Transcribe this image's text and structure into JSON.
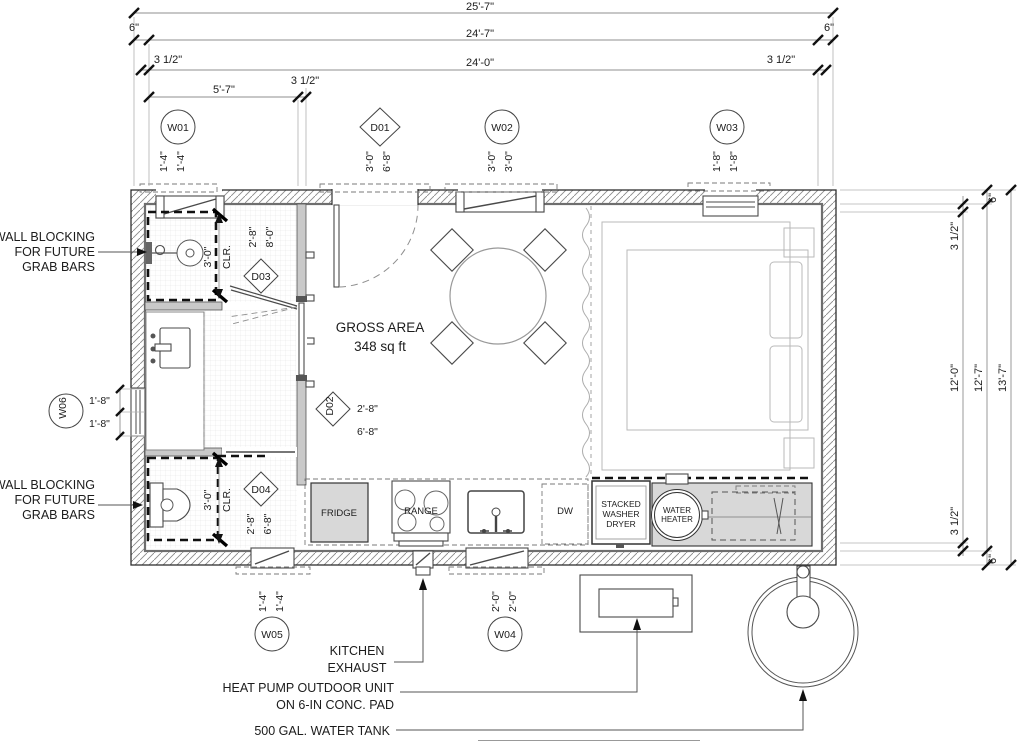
{
  "drawing_title": "Tiny house floor plan",
  "top_dims": {
    "overall": "25'-7\"",
    "six_left": "6\"",
    "six_right": "6\"",
    "inner": "24'-7\"",
    "half_left": "3 1/2\"",
    "half_right": "3 1/2\"",
    "stud": "24'-0\"",
    "bath": "5'-7\"",
    "bath_wall": "3 1/2\""
  },
  "right_dims": {
    "six_top": "6\"",
    "half_top": "3 1/2\"",
    "stud": "12'-0\"",
    "inner": "12'-7\"",
    "overall": "13'-7\"",
    "half_bot": "3 1/2\"",
    "six_bot": "6\""
  },
  "tags": {
    "w01": {
      "label": "W01",
      "a": "1'-4\"",
      "b": "1'-4\""
    },
    "d01": {
      "label": "D01",
      "a": "3'-0\"",
      "b": "6'-8\""
    },
    "w02": {
      "label": "W02",
      "a": "3'-0\"",
      "b": "3'-0\""
    },
    "w03": {
      "label": "W03",
      "a": "1'-8\"",
      "b": "1'-8\""
    },
    "w04": {
      "label": "W04",
      "a": "2'-0\"",
      "b": "2'-0\""
    },
    "w05": {
      "label": "W05",
      "a": "1'-4\"",
      "b": "1'-4\""
    },
    "w06": {
      "label": "W06",
      "a": "1'-8\"",
      "b": "1'-8\""
    },
    "d02": {
      "label": "D02",
      "a": "2'-8\"",
      "b": "6'-8\""
    },
    "d03": {
      "label": "D03",
      "a": "2'-8\"",
      "b": "8'-0\""
    },
    "d04": {
      "label": "D04",
      "a": "2'-8\"",
      "b": "6'-8\""
    }
  },
  "clearances": {
    "shower_a": "3'-0\"",
    "shower_b": "CLR.",
    "toilet_a": "3'-0\"",
    "toilet_b": "CLR."
  },
  "notes": {
    "blocking1": "WALL BLOCKING",
    "blocking2": "FOR FUTURE",
    "blocking3": "GRAB BARS",
    "area1": "GROSS AREA",
    "area2": "348 sq ft",
    "exhaust1": "KITCHEN",
    "exhaust2": "EXHAUST",
    "heatpump1": "HEAT PUMP OUTDOOR UNIT",
    "heatpump2": "ON 6-IN CONC. PAD",
    "tank": "500 GAL. WATER TANK"
  },
  "appliances": {
    "fridge": "FRIDGE",
    "range": "RANGE",
    "dw": "DW",
    "washer1": "STACKED",
    "washer2": "WASHER",
    "washer3": "DRYER",
    "wh1": "WATER",
    "wh2": "HEATER"
  },
  "colors": {
    "line": "#3f3f3f",
    "dim_line": "#8f8f8f",
    "heavy_dash": "#101010",
    "gray_fill": "#d8d8d8",
    "light_fixture": "#b9b9b9",
    "text": "#1c1c1c"
  }
}
